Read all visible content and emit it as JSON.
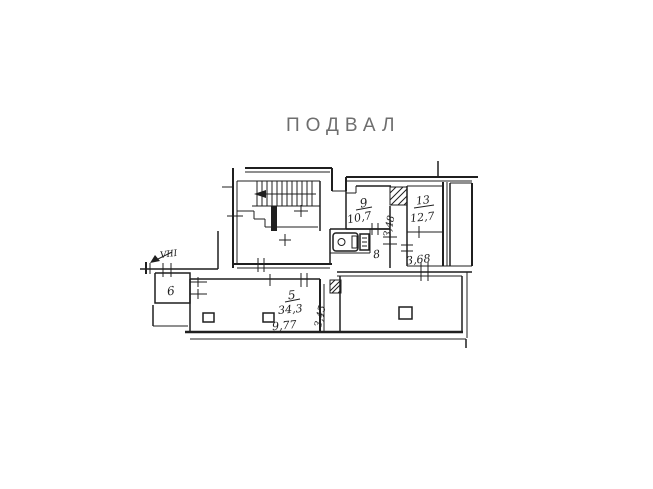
{
  "title": "ПОДВАЛ",
  "rooms": {
    "stairwell_label": "VIII",
    "room6_number": "6",
    "room5_number": "5",
    "room5_area": "34,3",
    "room5_width_dim": "9,77",
    "room5_depth_dim": "3,45",
    "room8_number": "8",
    "room9_number": "9",
    "room9_area": "10,7",
    "room9_depth_dim": "3,48",
    "room13_number": "13",
    "room13_area": "12,7",
    "room368_area": "3,68"
  },
  "colors": {
    "ink": "#1f1f1f",
    "title_text": "#6e6e6e",
    "paper": "#ffffff"
  }
}
